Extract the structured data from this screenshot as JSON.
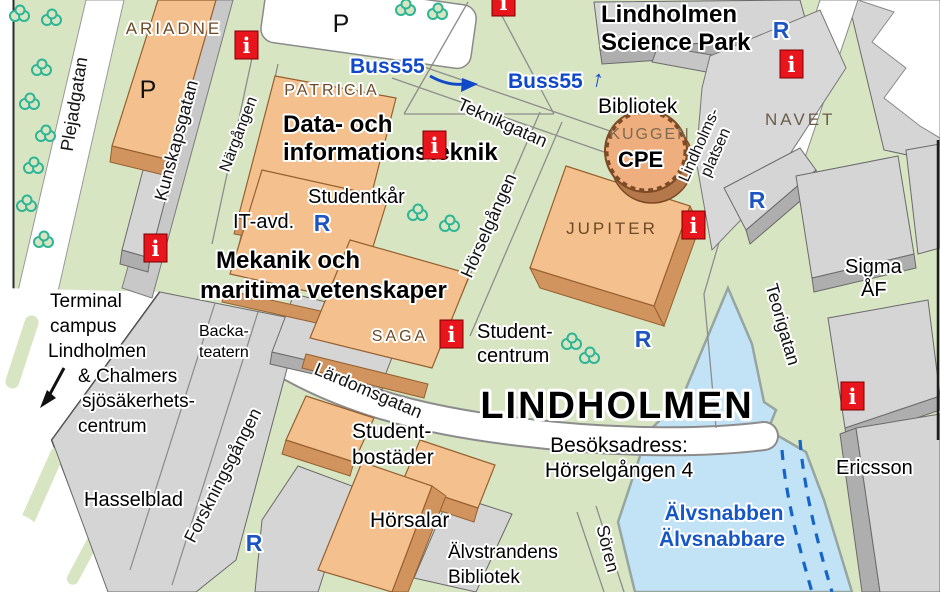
{
  "map": {
    "streets": {
      "plejadgatan": "Plejadgatan",
      "kunskapsgatan": "Kunskapsgatan",
      "nargangen": "Närgången",
      "teknikgatan": "Teknikgatan",
      "horselgangen": "Hörselgången",
      "lindholmsplatsen_1": "Lindholms-",
      "lindholmsplatsen_2": "platsen",
      "teorigatan": "Teorigatan",
      "lardomsgatan": "Lärdomsgatan",
      "forskningsgangen": "Forskningsgången",
      "soren": "Sören"
    },
    "buildings": {
      "ariadne": "ARIADNE",
      "patricia": "PATRICIA",
      "kuggen": "KUGGEN",
      "jupiter": "JUPITER",
      "navet": "NAVET",
      "saga": "SAGA"
    },
    "places": {
      "science_park_1": "Lindholmen",
      "science_park_2": "Science Park",
      "bibliotek": "Bibliotek",
      "cpe": "CPE",
      "data_1": "Data- och",
      "data_2": "informationsteknik",
      "studentkar": "Studentkår",
      "it_avd": "IT-avd.",
      "mekanik_1": "Mekanik och",
      "mekanik_2": "maritima vetenskaper",
      "studentcentrum_1": "Student-",
      "studentcentrum_2": "centrum",
      "lindholmen": "LINDHOLMEN",
      "besok_1": "Besöksadress:",
      "besok_2": "Hörselgången 4",
      "terminal_1": "Terminal",
      "terminal_2": "campus",
      "terminal_3": "Lindholmen",
      "terminal_4": "& Chalmers",
      "terminal_5": "sjösäkerhets-",
      "terminal_6": "centrum",
      "backa_1": "Backa-",
      "backa_2": "teatern",
      "hasselblad": "Hasselblad",
      "bostader_1": "Student-",
      "bostader_2": "bostäder",
      "horsalar": "Hörsalar",
      "alvstrandens_1": "Älvstrandens",
      "alvstrandens_2": "Bibliotek",
      "ericsson": "Ericsson",
      "sigma_1": "Sigma",
      "sigma_2": "ÅF",
      "alvsnabben_1": "Älvsnabben",
      "alvsnabben_2": "Älvsnabbare"
    },
    "transit": {
      "buss55": "Buss55",
      "parking": "P",
      "r_stop": "R",
      "info": "i",
      "up_arrow": "↑"
    },
    "colors": {
      "park_green": "#d8e5c3",
      "road_white": "#ffffff",
      "campus_orange": "#f4c08d",
      "building_gray": "#d5d5d5",
      "water_blue": "#c2e2f6",
      "transit_blue": "#1557c6",
      "info_red": "#e8151d",
      "building_label_brown": "#6d4a26"
    }
  }
}
